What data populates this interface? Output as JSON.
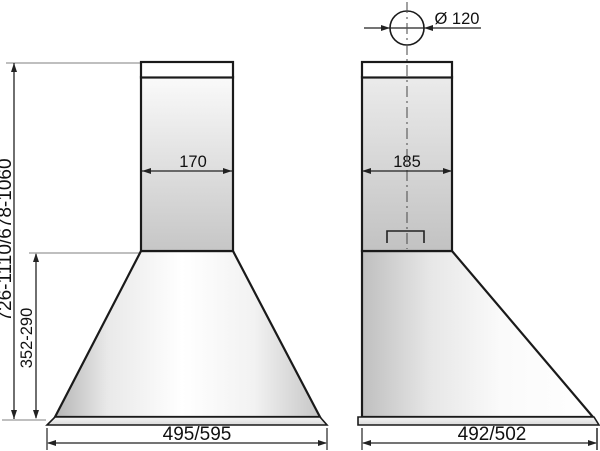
{
  "drawing": {
    "front_view": {
      "chimney_width": "170",
      "hood_height_range": "352-290",
      "overall_height_range": "726-1110/678-1060",
      "base_width": "495/595"
    },
    "side_view": {
      "duct_diameter": "Ø 120",
      "chimney_depth": "185",
      "base_depth": "492/502"
    },
    "colors": {
      "outline": "#1a1a1a",
      "dimension_line": "#222222",
      "extension_line": "#999999",
      "background": "#ffffff",
      "body_fill_light": "#f7f7f7",
      "body_fill_shade": "#c5c5c5"
    }
  }
}
